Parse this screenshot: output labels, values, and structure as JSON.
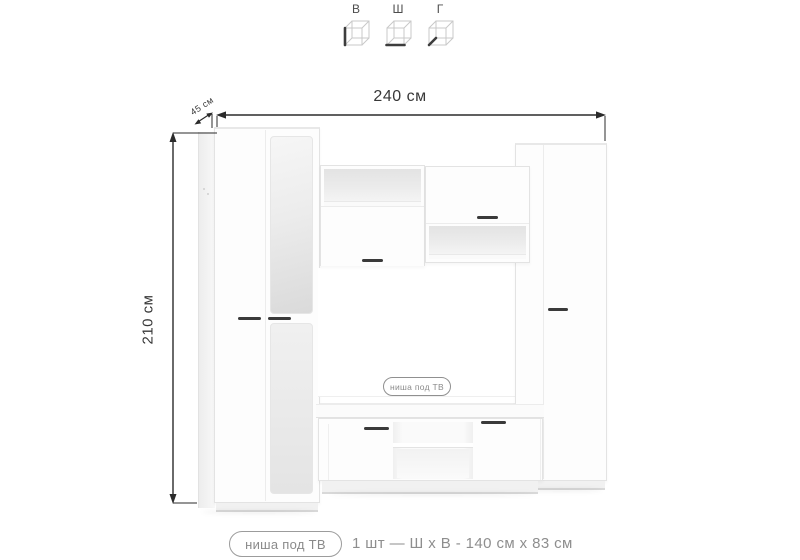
{
  "orientation_key": {
    "items": [
      {
        "label": "В",
        "axis": "height"
      },
      {
        "label": "Ш",
        "axis": "width"
      },
      {
        "label": "Г",
        "axis": "depth"
      }
    ]
  },
  "dimensions": {
    "width": "240 см",
    "depth": "45 см",
    "height": "210 см"
  },
  "tv_niche": {
    "tag": "ниша под ТВ"
  },
  "footer": {
    "tag": "ниша под ТВ",
    "spec": "1 шт — Ш х В - 140 см х 83 см"
  },
  "colors": {
    "dimension_line": "#2b2b2b",
    "dimension_text": "#383838",
    "muted_text": "#8e8e8e",
    "handle": "#3a3a3a",
    "furniture_edge": "#e3e3e3"
  }
}
